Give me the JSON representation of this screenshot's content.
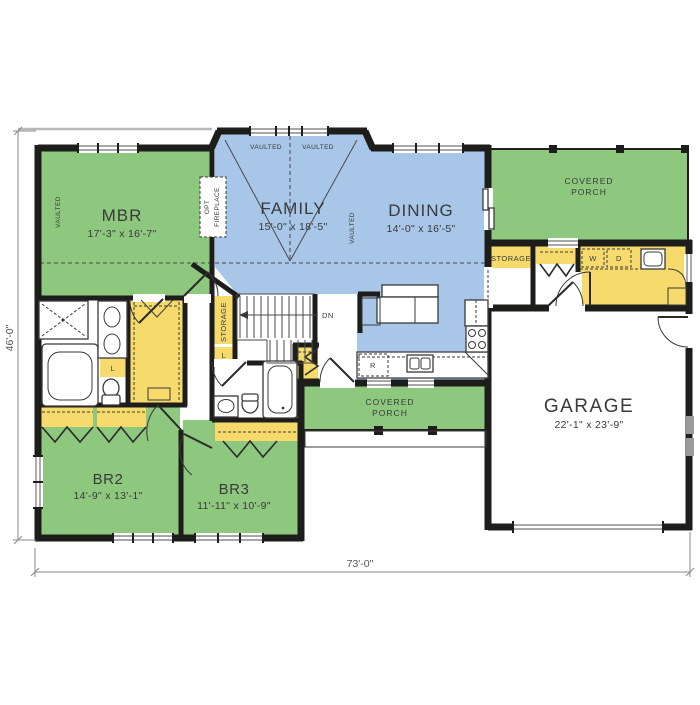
{
  "floor_plan": {
    "overall_width": "73'-0\"",
    "overall_depth": "46'-0\"",
    "rooms": {
      "mbr": {
        "name": "MBR",
        "dims": "17'-3\" x 16'-7\""
      },
      "family": {
        "name": "FAMILY",
        "dims": "15'-0\" x 18'-5\""
      },
      "dining": {
        "name": "DINING",
        "dims": "14'-0\" x 16'-5\""
      },
      "garage": {
        "name": "GARAGE",
        "dims": "22'-1\" x 23'-9\""
      },
      "br2": {
        "name": "BR2",
        "dims": "14'-9\" x 13'-1\""
      },
      "br3": {
        "name": "BR3",
        "dims": "11'-11\" x 10'-9\""
      },
      "rear_porch": {
        "line1": "COVERED",
        "line2": "PORCH"
      },
      "front_porch": {
        "line1": "COVERED",
        "line2": "PORCH"
      }
    },
    "annotations": {
      "vaulted": "VAULTED",
      "opt_fireplace_line1": "OPT",
      "opt_fireplace_line2": "FIREPLACE",
      "storage_room": "STORAGE",
      "hall_storage": "STORAGE",
      "linen": "L",
      "washer": "W",
      "dryer": "D",
      "refrigerator": "R",
      "stairs_down": "DN"
    },
    "colors": {
      "bedroom_green": "#8dc87e",
      "living_blue": "#a8c6e7",
      "closet_yellow": "#f6db6c",
      "wall": "#1d1d1b"
    }
  }
}
